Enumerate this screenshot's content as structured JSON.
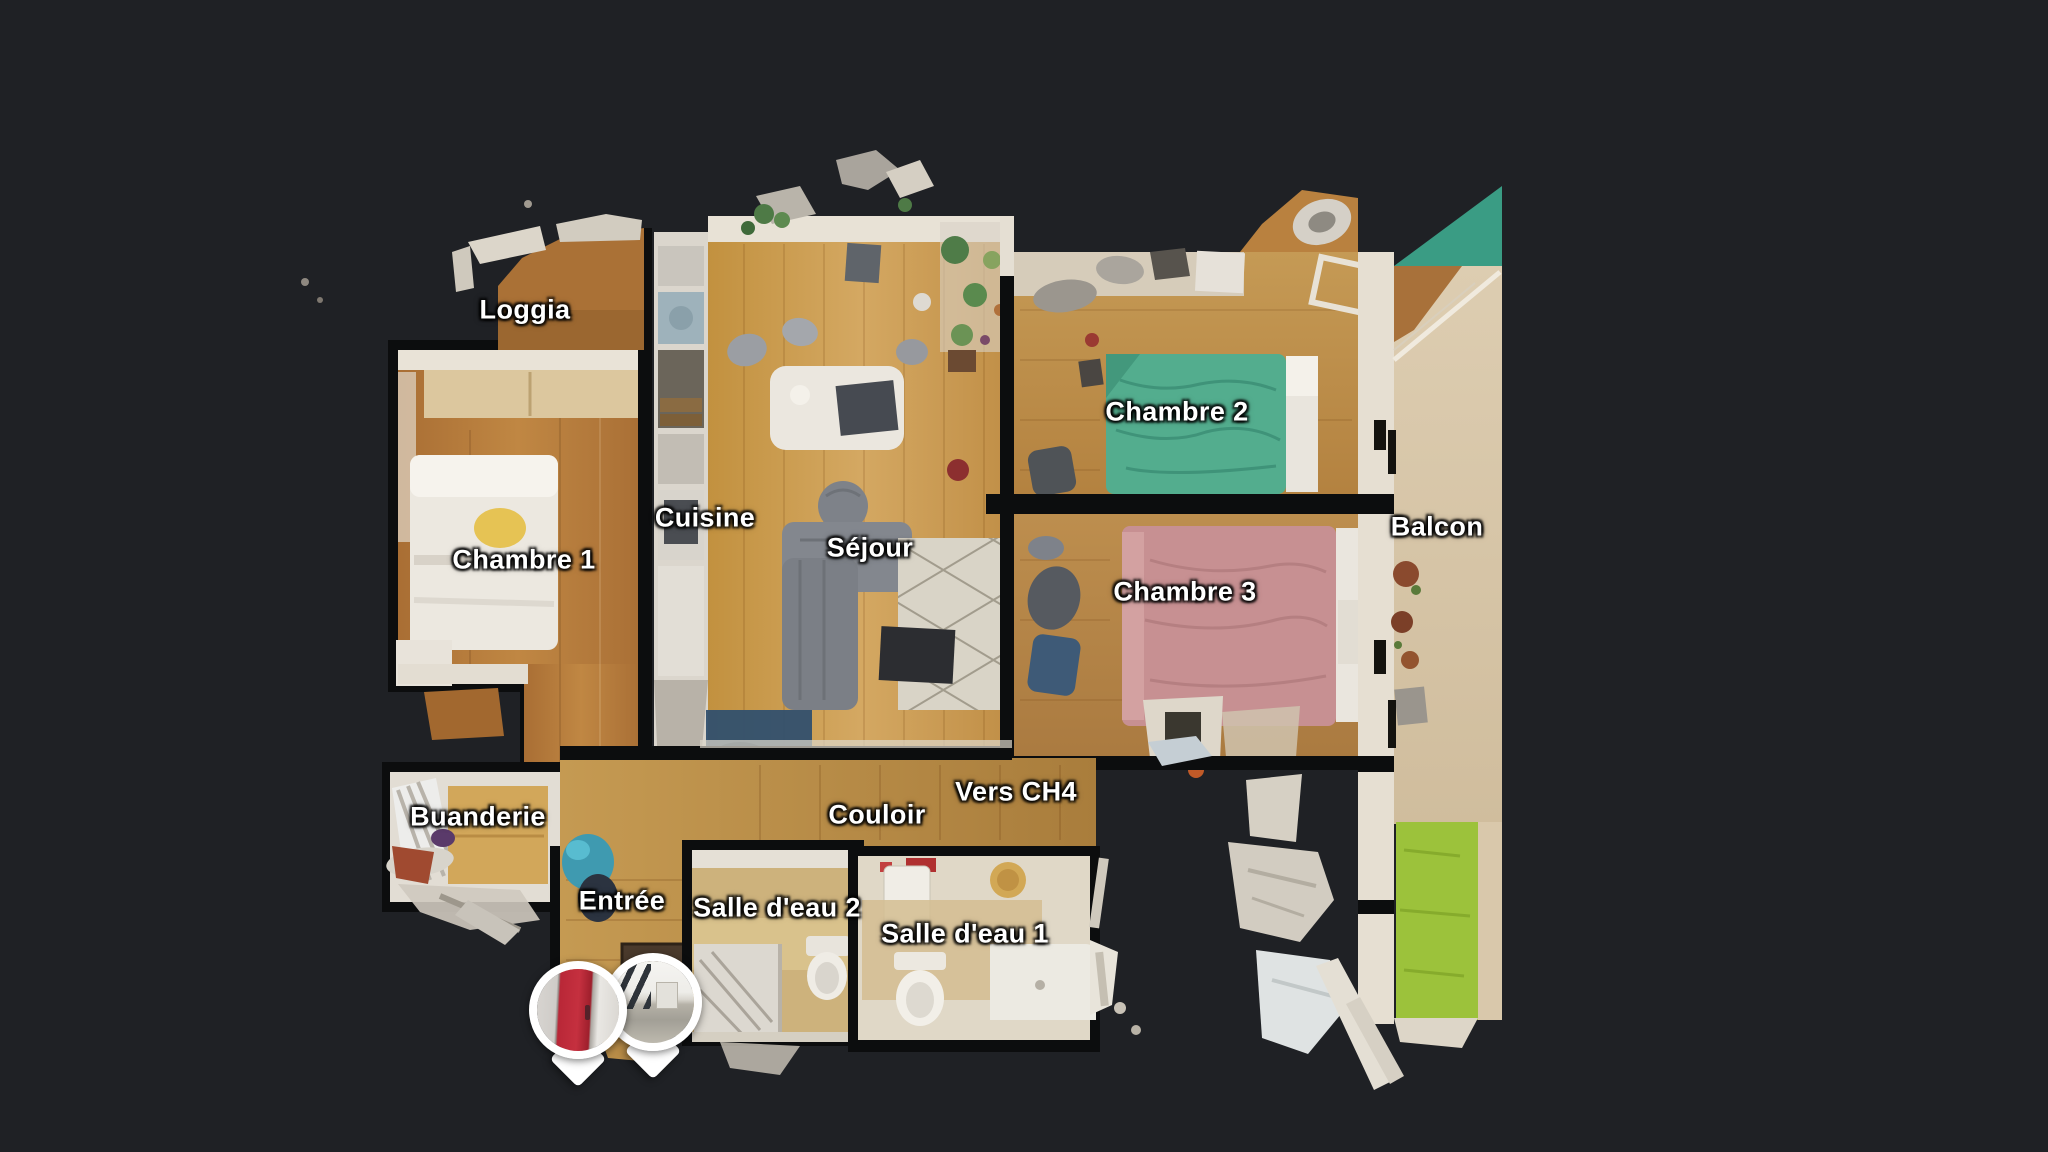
{
  "view": {
    "name": "3D tour floor plan view",
    "background": "#1f2125"
  },
  "floorplan": {
    "rooms": [
      {
        "id": "loggia",
        "label": "Loggia"
      },
      {
        "id": "chambre-1",
        "label": "Chambre 1"
      },
      {
        "id": "cuisine",
        "label": "Cuisine"
      },
      {
        "id": "sejour",
        "label": "Séjour"
      },
      {
        "id": "chambre-2",
        "label": "Chambre 2"
      },
      {
        "id": "chambre-3",
        "label": "Chambre 3"
      },
      {
        "id": "balcon",
        "label": "Balcon"
      },
      {
        "id": "buanderie",
        "label": "Buanderie"
      },
      {
        "id": "couloir",
        "label": "Couloir"
      },
      {
        "id": "vers-ch4",
        "label": "Vers CH4"
      },
      {
        "id": "entree",
        "label": "Entrée"
      },
      {
        "id": "salle-deau-2",
        "label": "Salle d'eau 2"
      },
      {
        "id": "salle-deau-1",
        "label": "Salle d'eau 1"
      }
    ],
    "colors": {
      "background": "#1f2125",
      "label_text": "#ffffff",
      "wall_dark": "#0c0d0e",
      "wall_light": "#e7e1d4",
      "wood_floor": "#c2913f",
      "bed_chambre_1": "#ece8e0",
      "bed_chambre_2": "#53ad8e",
      "bed_chambre_3": "#c79092",
      "sofa_gray": "#83878e",
      "rug_cream": "#d9d4c7",
      "rug_navy": "#31506e",
      "balcony_grass": "#9cc23b",
      "balcony_awning_teal": "#3a9c84",
      "pin_door_red": "#b92737"
    }
  },
  "pins": [
    {
      "id": "pin-entrance-door",
      "photo_subject": "Red entrance door"
    },
    {
      "id": "pin-building-exterior",
      "photo_subject": "Building exterior view"
    }
  ]
}
